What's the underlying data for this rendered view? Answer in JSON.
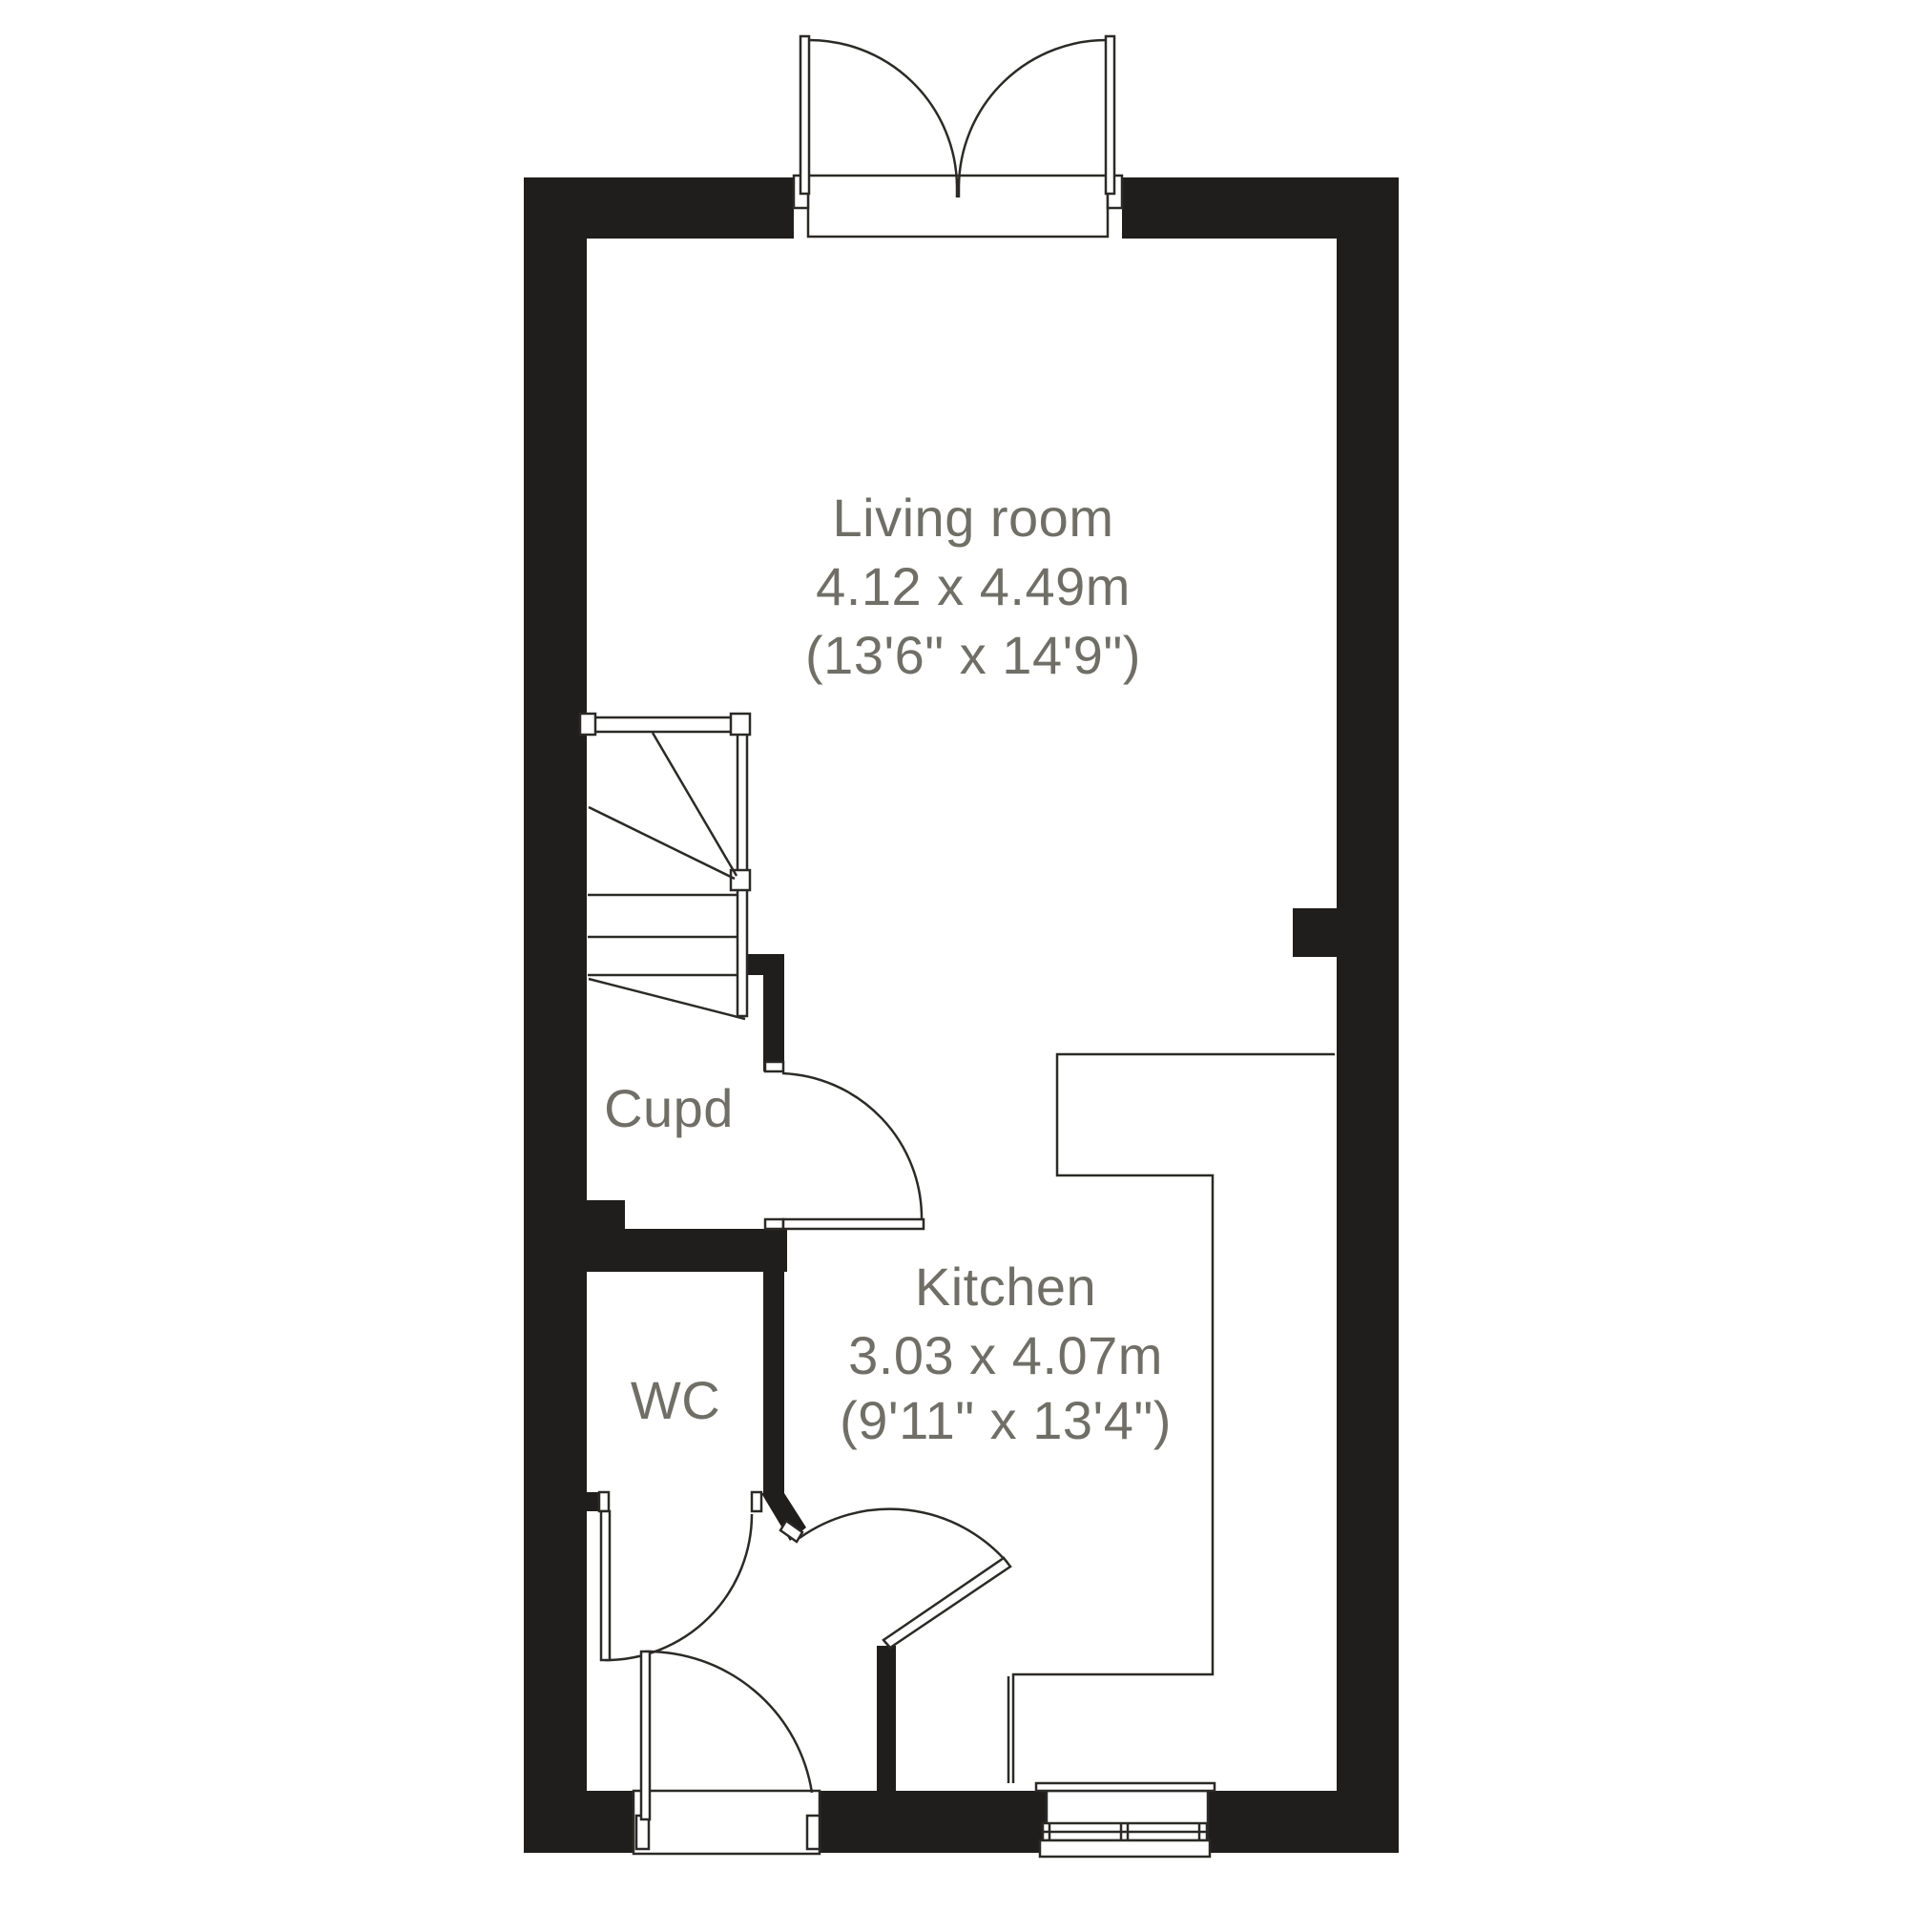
{
  "floorplan": {
    "colors": {
      "background": "#ffffff",
      "wall": "#1f1e1c",
      "line": "#2b2a27",
      "label": "#6f6f67"
    },
    "rooms": {
      "living_room": {
        "label": "Living room",
        "size_metric": "4.12 x 4.49m",
        "size_imperial": "(13'6\" x 14'9\")"
      },
      "kitchen": {
        "label": "Kitchen",
        "size_metric": "3.03 x 4.07m",
        "size_imperial": "(9'11\" x 13'4\")"
      },
      "cupboard": {
        "label": "Cupd"
      },
      "wc": {
        "label": "WC"
      }
    }
  }
}
